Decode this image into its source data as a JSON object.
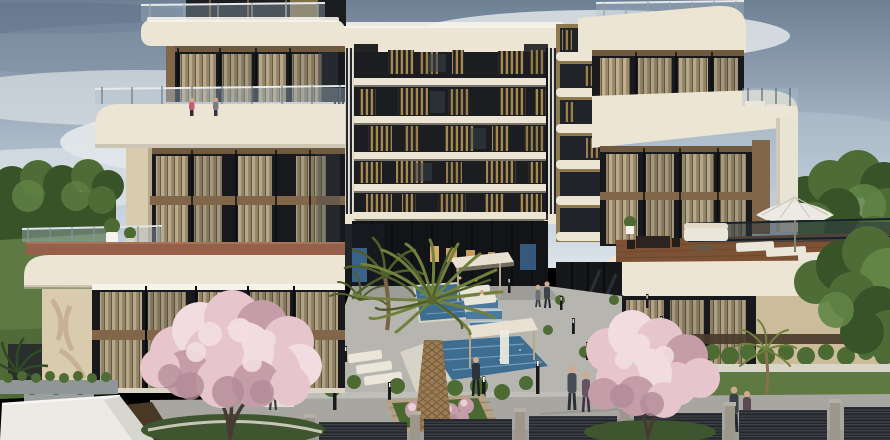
{
  "scene": {
    "type": "architectural-rendering",
    "subject": "Modern residential apartment complex render: central multi-storey block with bronze louvres, two cream terraced wing villas, courtyard with pools, pergolas, palms, blossoming trees, roof terrace with parasol, people on walkways, slatted perimeter fence",
    "objects": [
      "sky with clouds",
      "central apartment tower",
      "left terraced building",
      "right terraced building",
      "roof terrace furniture",
      "white parasol",
      "courtyard pools",
      "pergola cabanas",
      "sun loungers",
      "large palm tree",
      "pink blossom trees",
      "round shrubs",
      "bollard lights",
      "perimeter slat fence",
      "lawn",
      "background trees",
      "people"
    ]
  },
  "colors": {
    "sky_top": "#6e8094",
    "sky_mid": "#a2b1c0",
    "sky_low": "#c8d3de",
    "sky_horizon": "#dde4ea",
    "cloud_bright": "#e9eced",
    "cloud_dark": "#7b8ea1",
    "band_cream": "#ece5d4",
    "band_shadow": "#bbb19c",
    "white_trim": "#f6f3ea",
    "glass_dark": "#17191d",
    "glass_mid": "#3c444e",
    "mullion": "#0b0c0f",
    "curtain_light": "#c7b795",
    "curtain_dark": "#a08e6c",
    "wood": "#82664a",
    "wood_dark": "#5d4733",
    "gold_slat": "#a6894e",
    "gold_wall": "#8f7a4e",
    "stripe_light": "#e8e4d9",
    "stripe_dark": "#25272c",
    "stucco": "#d8cbae",
    "beige_wall": "#cbbd9c",
    "terracotta": "#955f49",
    "deck_wood": "#7c5134",
    "water": "#3e6d92",
    "water_light": "#85acc6",
    "walkway": "#b7b5af",
    "walkway_dark": "#a8a6a0",
    "grass": "#5e7943",
    "grass_dark": "#3e5530",
    "hedge": "#4d6a33",
    "palm_green": "#70803d",
    "palm_dark": "#4f5f2b",
    "tree_green": "#4d6c36",
    "tree_dark": "#395328",
    "tree_light": "#628546",
    "blossom": "#e6c5cc",
    "blossom_light": "#f1dde1",
    "blossom_deep": "#c59da9",
    "blossom_shadow": "#b28b97",
    "trunk_brown": "#9c7c52",
    "trunk_line": "#6a5137",
    "branch_dark": "#483932",
    "fence_dark": "#23262a",
    "fence_line": "#40444a",
    "post_grey": "#9c968b",
    "furniture_white": "#ebe6da",
    "umbrella": "#edeae3",
    "warm_light": "#e5b469",
    "blue_glass": "#40709f",
    "railing_glass": "#a9bcca",
    "skin": "#d2a98b",
    "people_pink": "#c75d72",
    "people_dark": "#343a42"
  }
}
